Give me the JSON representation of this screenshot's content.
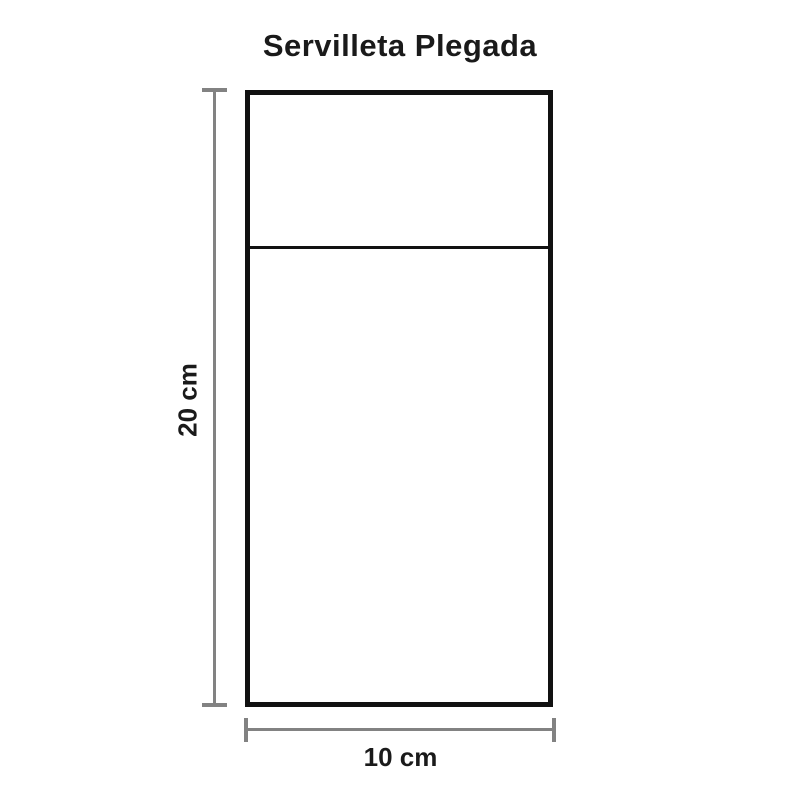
{
  "diagram": {
    "title": "Servilleta Plegada",
    "shape": {
      "name": "folded-napkin-rectangle",
      "height_cm": 20,
      "width_cm": 10,
      "fold_position": "upper quarter"
    },
    "dimensions": {
      "height_label": "20 cm",
      "width_label": "10 cm"
    },
    "colors": {
      "shape_stroke": "#111111",
      "dimension_line": "#828282",
      "text_color": "#1a1a1a",
      "background": "#ffffff"
    }
  }
}
